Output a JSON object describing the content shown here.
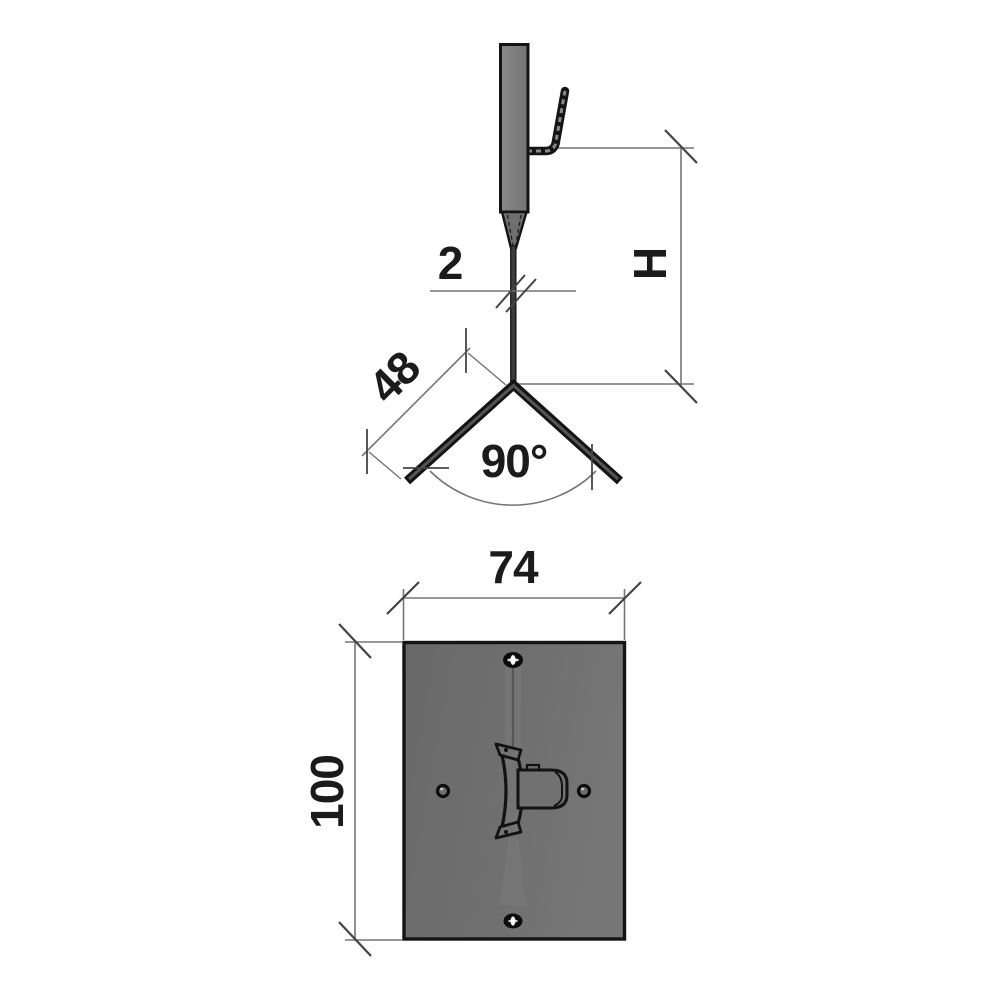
{
  "colors": {
    "background": "#ffffff",
    "outline": "#141414",
    "metal_fill": "#7e7e7e",
    "plate_fill_left": "#696969",
    "plate_fill_right": "#767676",
    "dim_line": "#757575",
    "tick": "#444444",
    "text": "#1b1b1b"
  },
  "side_view": {
    "dim_stem_width": {
      "label": "2"
    },
    "dim_height": {
      "label": "H"
    },
    "dim_arm_length": {
      "label": "48"
    },
    "dim_leg_angle": {
      "label": "90°"
    }
  },
  "plate_view": {
    "dim_width": {
      "label": "74"
    },
    "dim_height": {
      "label": "100"
    }
  }
}
